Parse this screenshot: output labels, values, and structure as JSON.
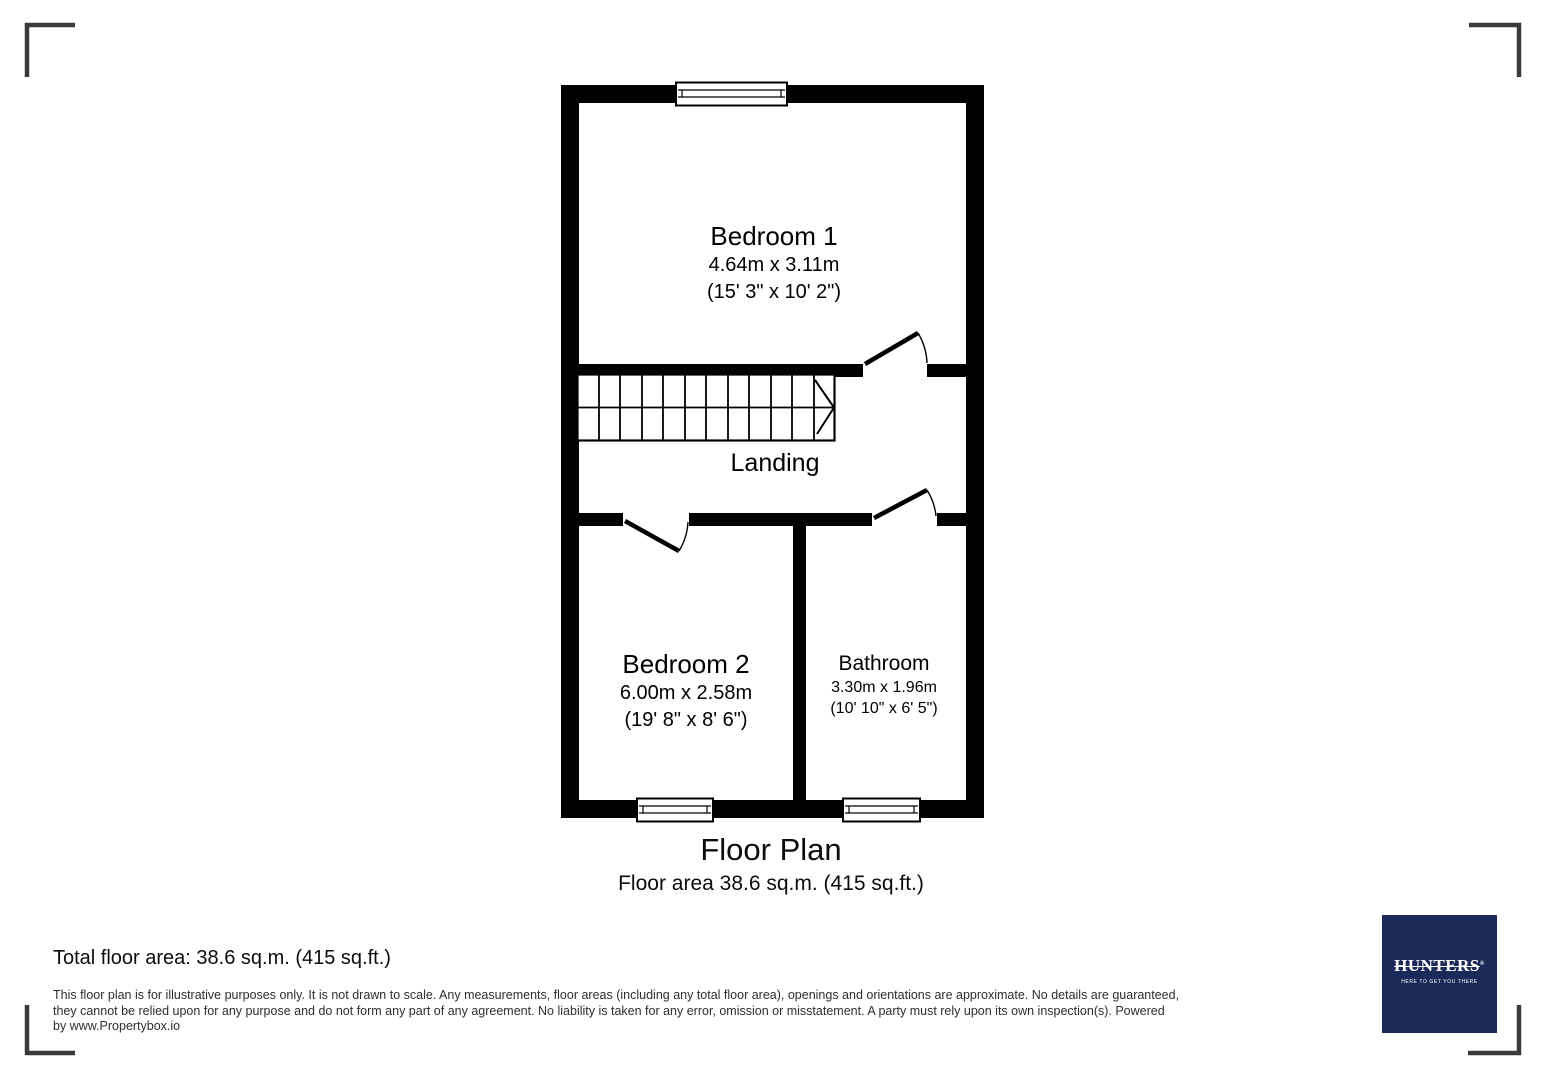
{
  "page": {
    "background": "#ffffff",
    "wall_color": "#000000",
    "bracket_color": "#3a3a3a"
  },
  "plan": {
    "rooms": {
      "bedroom1": {
        "name": "Bedroom 1",
        "metric": "4.64m x 3.11m",
        "imperial": "(15' 3\" x 10' 2\")"
      },
      "landing": {
        "name": "Landing"
      },
      "bedroom2": {
        "name": "Bedroom 2",
        "metric": "6.00m x 2.58m",
        "imperial": "(19' 8\" x 8' 6\")"
      },
      "bathroom": {
        "name": "Bathroom",
        "metric": "3.30m x 1.96m",
        "imperial": "(10' 10\" x 6' 5\")"
      }
    }
  },
  "caption": {
    "title": "Floor Plan",
    "subtitle": "Floor area 38.6 sq.m. (415 sq.ft.)"
  },
  "footer": {
    "total_area": "Total floor area: 38.6 sq.m. (415 sq.ft.)",
    "disclaimer_lines": [
      "This floor plan is for illustrative purposes only. It is not drawn to scale. Any measurements, floor areas (including any total floor area), openings and orientations are approximate. No details are guaranteed,",
      "they cannot be relied upon for any purpose and do not form any part of any agreement. No liability is taken for any error, omission or misstatement. A party must rely upon its own inspection(s). Powered",
      "by www.Propertybox.io"
    ]
  },
  "logo": {
    "brand": "HUNTERS",
    "registered": "®",
    "tagline": "HERE TO GET YOU THERE",
    "bg_color": "#1b2a58",
    "text_color": "#ffffff"
  }
}
